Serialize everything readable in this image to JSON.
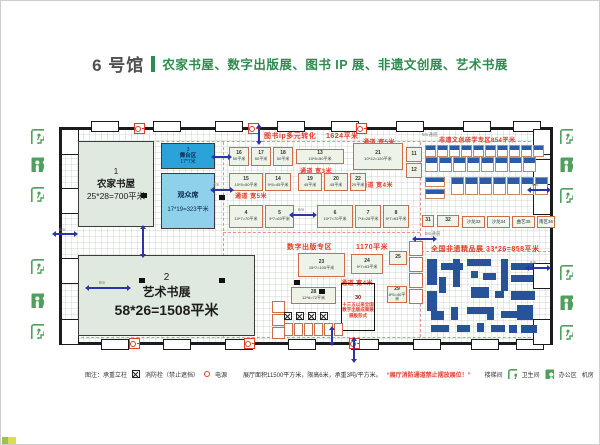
{
  "title": {
    "hall": "6 号馆",
    "subtitle": "农家书屋、数字出版展、图书 IP 展、非遗文创展、艺术书展"
  },
  "zones": {
    "zone1": {
      "num": "1",
      "name": "农家书屋",
      "size": "25*28=700平米"
    },
    "zone2": {
      "num": "2",
      "name": "艺术书展",
      "size": "58*26=1508平米"
    },
    "stage": {
      "num": "3",
      "name": "舞台区",
      "size": "17*7米"
    },
    "audience": {
      "name": "观众席",
      "size": "17*19=323平米"
    },
    "ip": {
      "name": "图书ip多元转化",
      "area": "1624平米"
    },
    "digital": {
      "name": "数字出版专区",
      "area": "1170平米"
    },
    "heritage": {
      "name": "非遗文创研学专区854平米"
    },
    "boutique": {
      "name": "全国非遗精品展  33*26=858平米"
    },
    "exhibit30": {
      "num": "30",
      "line1": "十三五以来全国",
      "line2": "数字出版成果展",
      "line3": "展板形式"
    }
  },
  "aisles": {
    "a5_top": "通道  宽5米",
    "a3_mid": "通道  宽3米",
    "a5_left": "通道  宽5米",
    "a4_right": "通道  宽4米",
    "a4_mid": "通道  宽4米"
  },
  "booths": {
    "rowA": [
      {
        "n": "16",
        "size": "50平米",
        "w": 18
      },
      {
        "n": "17",
        "size": "50平米",
        "w": 18
      },
      {
        "n": "18",
        "size": "50平米",
        "w": 18
      }
    ],
    "b13": {
      "n": "13",
      "size": "10*5=50平米"
    },
    "b21": {
      "n": "21",
      "size": "10*12=120平米"
    },
    "side1112": [
      {
        "n": "11",
        "w": 14,
        "h": 13
      },
      {
        "n": "12",
        "w": 14,
        "h": 13
      }
    ],
    "rowB": [
      {
        "n": "15",
        "size": "10*5=50平米",
        "w": 32
      },
      {
        "n": "14",
        "size": "9*5=45平米",
        "w": 24
      }
    ],
    "rowB2": [
      {
        "n": "19",
        "size": "45平米",
        "w": 22
      },
      {
        "n": "20",
        "size": "45平米",
        "w": 22
      },
      {
        "n": "22",
        "size": "20平米",
        "w": 14
      }
    ],
    "rowC": [
      {
        "n": "4",
        "size": "10*7=70平米",
        "w": 32
      },
      {
        "n": "5",
        "size": "9*7=63平米",
        "w": 27
      }
    ],
    "rowC2": [
      {
        "n": "6",
        "size": "10*7=70平米",
        "w": 34
      },
      {
        "n": "7",
        "size": "7*4=28平米",
        "w": 24
      },
      {
        "n": "8",
        "size": "9*7=63平米",
        "w": 24
      }
    ],
    "b23": {
      "n": "23",
      "size": "15*7=105平米"
    },
    "b24": {
      "n": "24",
      "size": "9*7=63平米"
    },
    "b25": {
      "n": "25",
      "size": "8*5=40平米"
    },
    "b28": {
      "n": "28",
      "size": "12*6=72平米"
    },
    "b29": {
      "n": "29",
      "size": "8*5=40平米"
    },
    "b31": {
      "n": "31"
    },
    "b32": {
      "n": "32"
    },
    "flats": [
      {
        "label": "沙龙33",
        "w": 21
      },
      {
        "label": "沙龙34",
        "w": 21
      },
      {
        "label": "曲艺35",
        "w": 21
      },
      {
        "label": "南区36",
        "w": 16
      }
    ],
    "stripA": [
      {},
      {},
      {},
      {},
      {},
      {},
      {},
      {},
      {},
      {}
    ],
    "stripB": [
      {},
      {},
      {},
      {},
      {},
      {},
      {},
      {}
    ],
    "stripC": [
      {},
      {},
      {},
      {},
      {},
      {},
      {}
    ],
    "vstrip": [
      {},
      {},
      {},
      {}
    ],
    "cells3": [
      {},
      {},
      {}
    ],
    "cells6": [
      {},
      {},
      {},
      {},
      {},
      {}
    ]
  },
  "dims": [
    {
      "x": 212,
      "y": 181,
      "t": "4m"
    },
    {
      "x": 58,
      "y": 226,
      "t": "6m"
    },
    {
      "x": 98,
      "y": 279,
      "t": "8m"
    },
    {
      "x": 297,
      "y": 206,
      "t": "6m"
    },
    {
      "x": 531,
      "y": 181,
      "t": "6m"
    },
    {
      "x": 529,
      "y": 259,
      "t": "6m"
    },
    {
      "x": 424,
      "y": 230,
      "t": "9m通道"
    },
    {
      "x": 421,
      "y": 131,
      "t": "5m通道"
    }
  ],
  "layout": {
    "doors_top": [
      {
        "x": 90,
        "y": 120
      },
      {
        "x": 152,
        "y": 120
      },
      {
        "x": 214,
        "y": 120
      },
      {
        "x": 276,
        "y": 120
      },
      {
        "x": 330,
        "y": 120
      },
      {
        "x": 395,
        "y": 120
      },
      {
        "x": 462,
        "y": 120
      },
      {
        "x": 512,
        "y": 120
      }
    ],
    "doors_bottom": [
      {
        "x": 100,
        "y": 338
      },
      {
        "x": 162,
        "y": 338
      },
      {
        "x": 224,
        "y": 338
      },
      {
        "x": 287,
        "y": 338
      },
      {
        "x": 350,
        "y": 338
      },
      {
        "x": 412,
        "y": 338
      },
      {
        "x": 470,
        "y": 338
      },
      {
        "x": 515,
        "y": 338
      }
    ],
    "doors_left": [
      {
        "x": 60,
        "y": 128
      },
      {
        "x": 60,
        "y": 187
      },
      {
        "x": 60,
        "y": 257
      },
      {
        "x": 60,
        "y": 318
      }
    ],
    "doors_right": [
      {
        "x": 532,
        "y": 128
      },
      {
        "x": 532,
        "y": 158
      },
      {
        "x": 532,
        "y": 188
      },
      {
        "x": 532,
        "y": 262
      },
      {
        "x": 532,
        "y": 318
      }
    ],
    "hydrants": [
      {
        "x": 133,
        "y": 122
      },
      {
        "x": 247,
        "y": 122
      },
      {
        "x": 355,
        "y": 122
      },
      {
        "x": 128,
        "y": 337
      },
      {
        "x": 243,
        "y": 337
      },
      {
        "x": 348,
        "y": 337
      }
    ],
    "bsqs": [
      {
        "x": 140,
        "y": 192
      },
      {
        "x": 218,
        "y": 194
      },
      {
        "x": 138,
        "y": 277
      },
      {
        "x": 218,
        "y": 277
      },
      {
        "x": 293,
        "y": 279
      },
      {
        "x": 318,
        "y": 288
      }
    ],
    "xmarks": [
      {
        "x": 283,
        "y": 311
      },
      {
        "x": 295,
        "y": 311
      },
      {
        "x": 307,
        "y": 311
      },
      {
        "x": 319,
        "y": 311
      }
    ],
    "arr_h": [
      {
        "x": 213,
        "y": 188,
        "w": 16
      },
      {
        "x": 55,
        "y": 232,
        "w": 18
      },
      {
        "x": 88,
        "y": 286,
        "w": 38
      },
      {
        "x": 292,
        "y": 213,
        "w": 20
      },
      {
        "x": 530,
        "y": 188,
        "w": 16
      },
      {
        "x": 528,
        "y": 266,
        "w": 18
      },
      {
        "x": 415,
        "y": 237,
        "w": 17
      },
      {
        "x": 214,
        "y": 155,
        "w": 13
      }
    ],
    "arr_v": [
      {
        "x": 257,
        "y": 127,
        "h": 13
      },
      {
        "x": 141,
        "y": 228,
        "h": 25
      },
      {
        "x": 330,
        "y": 329,
        "h": 12
      },
      {
        "x": 352,
        "y": 340,
        "h": 18
      }
    ],
    "furniture": [
      {
        "x": 2,
        "y": 4,
        "w": 10,
        "h": 26
      },
      {
        "x": 2,
        "y": 36,
        "w": 10,
        "h": 20
      },
      {
        "x": 16,
        "y": 8,
        "w": 22,
        "h": 7
      },
      {
        "x": 14,
        "y": 22,
        "w": 7,
        "h": 16
      },
      {
        "x": 28,
        "y": 4,
        "w": 7,
        "h": 28
      },
      {
        "x": 42,
        "y": 4,
        "w": 24,
        "h": 7
      },
      {
        "x": 46,
        "y": 16,
        "w": 7,
        "h": 7
      },
      {
        "x": 58,
        "y": 18,
        "w": 13,
        "h": 7
      },
      {
        "x": 76,
        "y": 4,
        "w": 7,
        "h": 32
      },
      {
        "x": 86,
        "y": 8,
        "w": 22,
        "h": 7
      },
      {
        "x": 86,
        "y": 20,
        "w": 22,
        "h": 7
      },
      {
        "x": 46,
        "y": 32,
        "w": 18,
        "h": 11
      },
      {
        "x": 70,
        "y": 36,
        "w": 9,
        "h": 7
      },
      {
        "x": 86,
        "y": 36,
        "w": 24,
        "h": 9
      },
      {
        "x": 6,
        "y": 56,
        "w": 13,
        "h": 9
      },
      {
        "x": 26,
        "y": 52,
        "w": 7,
        "h": 13
      },
      {
        "x": 42,
        "y": 52,
        "w": 20,
        "h": 7
      },
      {
        "x": 62,
        "y": 52,
        "w": 7,
        "h": 13
      },
      {
        "x": 76,
        "y": 56,
        "w": 18,
        "h": 7
      },
      {
        "x": 92,
        "y": 50,
        "w": 16,
        "h": 15
      },
      {
        "x": 6,
        "y": 70,
        "w": 18,
        "h": 7
      },
      {
        "x": 32,
        "y": 70,
        "w": 13,
        "h": 7
      },
      {
        "x": 52,
        "y": 68,
        "w": 7,
        "h": 9
      },
      {
        "x": 66,
        "y": 70,
        "w": 14,
        "h": 7
      },
      {
        "x": 84,
        "y": 70,
        "w": 8,
        "h": 8
      },
      {
        "x": 96,
        "y": 70,
        "w": 16,
        "h": 8
      }
    ]
  },
  "legend": {
    "prefix": "图注：承重立柱",
    "hydrant_label": "消防栓（禁止遮挡）",
    "power_label": "电源",
    "specs": "展厅面积11500平方米，限高6米，承重3吨/平方米。",
    "warning": "“展厅消防通道禁止摆放展位！”",
    "stairs_left": "楼梯间",
    "stairs_right": "卫生间",
    "office": "办公区",
    "machine": "机房",
    "entrance": "出入口"
  },
  "colors": {
    "title_green": "#2e8b4f",
    "zone_fill": "#dfe9df",
    "stage_blue": "#2ba3d8",
    "audience_blue": "#8fd0ea",
    "booth_border": "#cf6b45",
    "red_label": "#e23c28",
    "furniture_blue": "#27539b",
    "icon_green": "#4fa05e",
    "arrow_blue": "#2a35a8",
    "wall": "#1c1c1c"
  }
}
